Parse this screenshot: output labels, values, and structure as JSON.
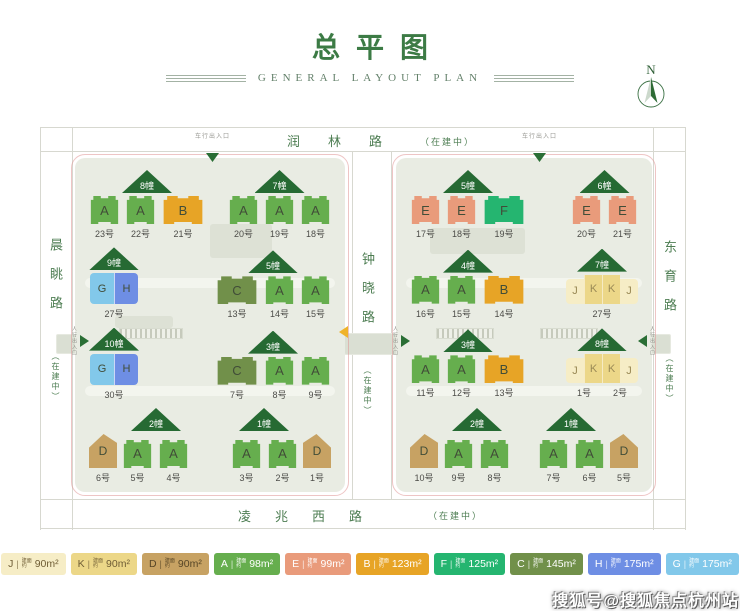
{
  "header": {
    "title": "总平图",
    "subtitle": "GENERAL LAYOUT PLAN",
    "compass_label": "N"
  },
  "roads": {
    "top": {
      "name": "润林路",
      "status": "（在建中）"
    },
    "left": {
      "name": "晨眺路",
      "status": "（在建中）"
    },
    "middle": {
      "name": "钟晓路",
      "status": "（在建中）"
    },
    "right": {
      "name": "东育路",
      "status": "（在建中）"
    },
    "bottom": {
      "name": "凌兆西路",
      "status": "（在建中）"
    }
  },
  "entrances": {
    "vehicle_label": "车行出入口",
    "pedestrian_label": "人行出入口"
  },
  "parcels": [
    {
      "rows": [
        {
          "groups": [
            {
              "block": "8幢",
              "units": [
                {
                  "t": "A",
                  "n": "23号"
                },
                {
                  "t": "A",
                  "n": "22号"
                },
                {
                  "t": "B",
                  "n": "21号"
                }
              ]
            },
            {
              "block": "7幢",
              "units": [
                {
                  "t": "A",
                  "n": "20号"
                },
                {
                  "t": "A",
                  "n": "19号"
                },
                {
                  "t": "A",
                  "n": "18号"
                }
              ]
            }
          ]
        },
        {
          "groups": [
            {
              "block": "9幢",
              "joined": true,
              "units": [
                {
                  "t": "G"
                },
                {
                  "t": "H"
                }
              ],
              "sub_labels": [
                "27号"
              ]
            },
            {
              "block": "5幢",
              "units": [
                {
                  "t": "C",
                  "n": "13号"
                },
                {
                  "t": "A",
                  "n": "14号"
                },
                {
                  "t": "A",
                  "n": "15号"
                }
              ]
            }
          ]
        },
        {
          "groups": [
            {
              "block": "10幢",
              "joined": true,
              "units": [
                {
                  "t": "G"
                },
                {
                  "t": "H"
                }
              ],
              "sub_labels": [
                "30号"
              ]
            },
            {
              "block": "3幢",
              "units": [
                {
                  "t": "C",
                  "n": "7号"
                },
                {
                  "t": "A",
                  "n": "8号"
                },
                {
                  "t": "A",
                  "n": "9号"
                }
              ]
            }
          ]
        },
        {
          "groups": [
            {
              "block": "2幢",
              "units": [
                {
                  "t": "D",
                  "n": "6号"
                },
                {
                  "t": "A",
                  "n": "5号"
                },
                {
                  "t": "A",
                  "n": "4号"
                }
              ]
            },
            {
              "block": "1幢",
              "units": [
                {
                  "t": "A",
                  "n": "3号"
                },
                {
                  "t": "A",
                  "n": "2号"
                },
                {
                  "t": "D",
                  "n": "1号"
                }
              ]
            }
          ]
        }
      ]
    },
    {
      "rows": [
        {
          "groups": [
            {
              "block": "5幢",
              "units": [
                {
                  "t": "E",
                  "n": "17号"
                },
                {
                  "t": "E",
                  "n": "18号"
                },
                {
                  "t": "F",
                  "n": "19号"
                }
              ]
            },
            {
              "block": "6幢",
              "units": [
                {
                  "t": "E",
                  "n": "20号"
                },
                {
                  "t": "E",
                  "n": "21号"
                }
              ]
            }
          ]
        },
        {
          "groups": [
            {
              "block": "4幢",
              "units": [
                {
                  "t": "A",
                  "n": "16号"
                },
                {
                  "t": "A",
                  "n": "15号"
                },
                {
                  "t": "B",
                  "n": "14号"
                }
              ]
            },
            {
              "block": "7幢",
              "joined": true,
              "units": [
                {
                  "t": "J"
                },
                {
                  "t": "K"
                },
                {
                  "t": "K"
                },
                {
                  "t": "J"
                }
              ],
              "sub_labels": [
                "27号"
              ]
            }
          ]
        },
        {
          "groups": [
            {
              "block": "3幢",
              "units": [
                {
                  "t": "A",
                  "n": "11号"
                },
                {
                  "t": "A",
                  "n": "12号"
                },
                {
                  "t": "B",
                  "n": "13号"
                }
              ]
            },
            {
              "block": "8幢",
              "joined": true,
              "units": [
                {
                  "t": "J"
                },
                {
                  "t": "K"
                },
                {
                  "t": "K"
                },
                {
                  "t": "J"
                }
              ],
              "sub_labels": [
                "1号",
                "2号"
              ]
            }
          ]
        },
        {
          "groups": [
            {
              "block": "2幢",
              "units": [
                {
                  "t": "D",
                  "n": "10号"
                },
                {
                  "t": "A",
                  "n": "9号"
                },
                {
                  "t": "A",
                  "n": "8号"
                }
              ]
            },
            {
              "block": "1幢",
              "units": [
                {
                  "t": "A",
                  "n": "7号"
                },
                {
                  "t": "A",
                  "n": "6号"
                },
                {
                  "t": "D",
                  "n": "5号"
                }
              ]
            }
          ]
        }
      ]
    }
  ],
  "legend": {
    "prefix": "建面约",
    "items": [
      {
        "t": "J",
        "area": "90m²",
        "fg": "#6f5d35"
      },
      {
        "t": "K",
        "area": "90m²",
        "fg": "#6f5d35"
      },
      {
        "t": "D",
        "area": "90m²",
        "fg": "#564526"
      },
      {
        "t": "A",
        "area": "98m²",
        "fg": "#ffffff"
      },
      {
        "t": "E",
        "area": "99m²",
        "fg": "#ffffff"
      },
      {
        "t": "B",
        "area": "123m²",
        "fg": "#ffffff"
      },
      {
        "t": "F",
        "area": "125m²",
        "fg": "#ffffff"
      },
      {
        "t": "C",
        "area": "145m²",
        "fg": "#ffffff"
      },
      {
        "t": "H",
        "area": "175m²",
        "fg": "#ffffff"
      },
      {
        "t": "G",
        "area": "175m²",
        "fg": "#ffffff"
      }
    ]
  },
  "colors": {
    "types": {
      "A": "#66ae4e",
      "B": "#e7a426",
      "C": "#71904a",
      "D": "#c7a263",
      "E": "#e99b7b",
      "F": "#25b570",
      "G": "#82c8ea",
      "H": "#6e8ee4",
      "J": "#f6edc6",
      "K": "#ecd788"
    },
    "marker_green": "#266a33",
    "road_text_green": "#4e7e53",
    "title_green": "#3c7b45",
    "entrance_arrow_yellow": "#efb32a"
  },
  "watermark": "搜狐号@搜狐焦点杭州站"
}
